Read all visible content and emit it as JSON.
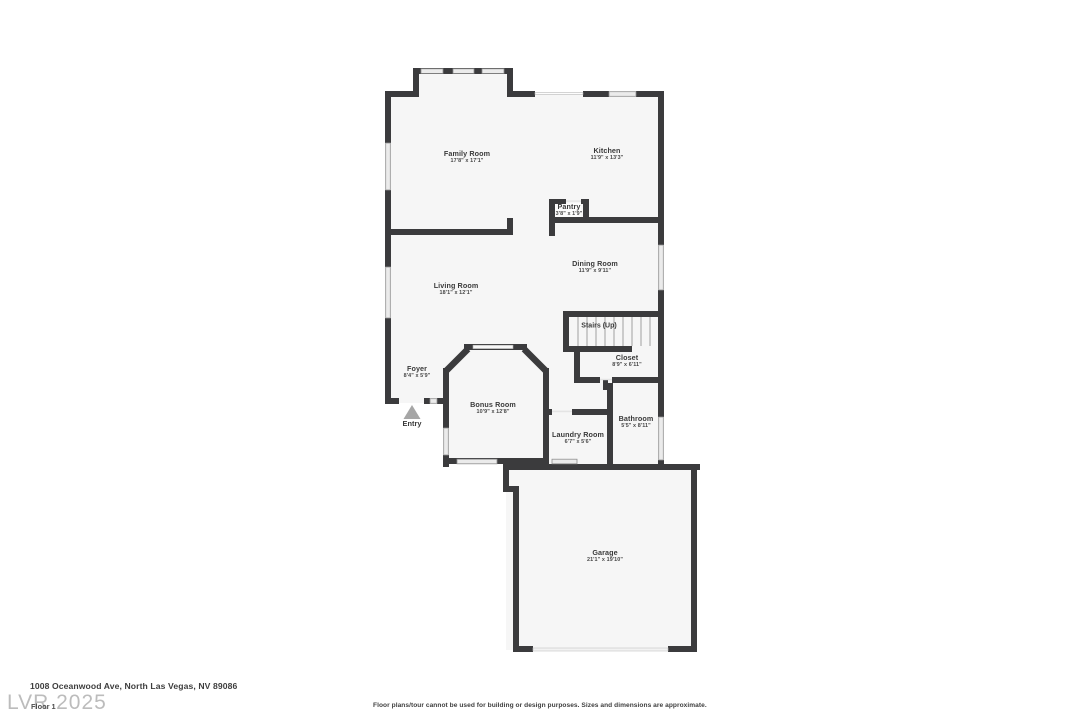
{
  "plan": {
    "rooms": [
      {
        "name": "Family Room",
        "dims": "17'8\" x 17'1\""
      },
      {
        "name": "Kitchen",
        "dims": "11'9\" x 13'3\""
      },
      {
        "name": "Pantry",
        "dims": "3'8\" x 1'9\""
      },
      {
        "name": "Dining Room",
        "dims": "11'9\" x 9'11\""
      },
      {
        "name": "Living Room",
        "dims": "18'1\" x 12'1\""
      },
      {
        "name": "Stairs (Up)",
        "dims": ""
      },
      {
        "name": "Closet",
        "dims": "8'9\" x 6'11\""
      },
      {
        "name": "Foyer",
        "dims": "8'4\" x 5'9\""
      },
      {
        "name": "Bonus Room",
        "dims": "10'9\" x 12'8\""
      },
      {
        "name": "Laundry Room",
        "dims": "6'7\" x 5'6\""
      },
      {
        "name": "Bathroom",
        "dims": "5'5\" x 8'11\""
      },
      {
        "name": "Garage",
        "dims": "21'1\" x 19'10\""
      }
    ],
    "entry_label": "Entry"
  },
  "footer": {
    "address": "1008 Oceanwood Ave, North Las Vegas, NV 89086",
    "floor_label": "Floor 1",
    "watermark": "LVR 2025",
    "disclaimer": "Floor plans/tour cannot be used for building or design purposes. Sizes and dimensions are approximate."
  },
  "colors": {
    "wall": "#3b3b3d",
    "floor": "#f6f6f6",
    "window_fill": "#ebebeb",
    "window_frame": "#8f8f8f",
    "entry_arrow": "#a6a6a6",
    "label_text": "#3a3a3a",
    "watermark_text": "#bcbcbc"
  }
}
